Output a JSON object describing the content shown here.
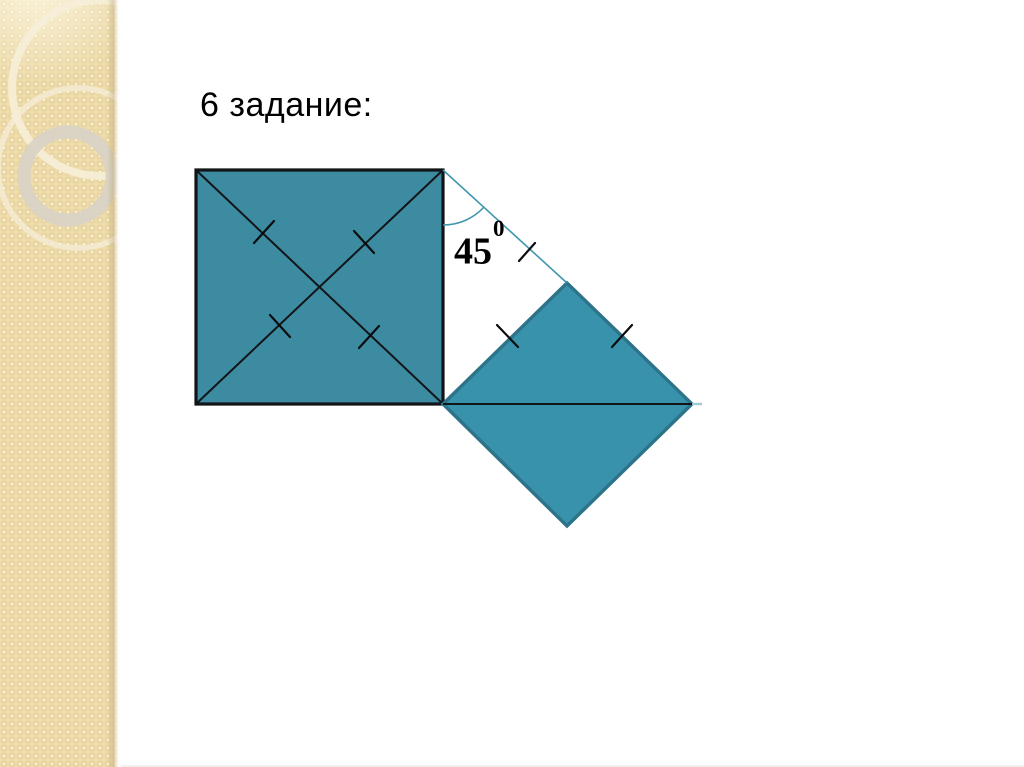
{
  "slide": {
    "title": "6 задание:"
  },
  "theme": {
    "page-bg": "#ffffff",
    "sidebar-bg": "#eedcab",
    "ring-cream": "#f6eed8",
    "ring-gray": "#d9d3c6",
    "square-fill": "#3c8ba0",
    "diamond-fill": "#3892ab",
    "diamond-stroke": "#2d7389",
    "outline-black": "#121518",
    "thin-teal": "#4096ad",
    "axis-ext": "#9fc9d3",
    "text-color": "#000000"
  },
  "figure": {
    "square": {
      "points": "196,170 443,170 443,404 196,404"
    },
    "diagonal_main": {
      "points": "196,170 443,404"
    },
    "diagonal_anti": {
      "points": "443,170 196,404"
    },
    "square_ticks": [
      {
        "points": "254,243 274,221"
      },
      {
        "points": "354,231 374,253"
      },
      {
        "points": "270,315 290,337"
      },
      {
        "points": "359,348 379,326"
      }
    ],
    "construction_line": {
      "points": "443,170 567,283"
    },
    "construction_tick": {
      "points": "519,261 535,243"
    },
    "diamond": {
      "points": "443,404 567,283 692,404 567,526"
    },
    "diamond_axis": {
      "points": "443,404 692,404"
    },
    "diamond_axis_extension": {
      "points": "692,404 702,404"
    },
    "diamond_ticks": [
      {
        "points": "497,325 518,347"
      },
      {
        "points": "612,347 632,325"
      }
    ],
    "angle_arc": {
      "d": "M 443 225 A 55 55 0 0 0 484 207"
    },
    "angle_label": {
      "base": "45",
      "exponent": "0"
    }
  }
}
